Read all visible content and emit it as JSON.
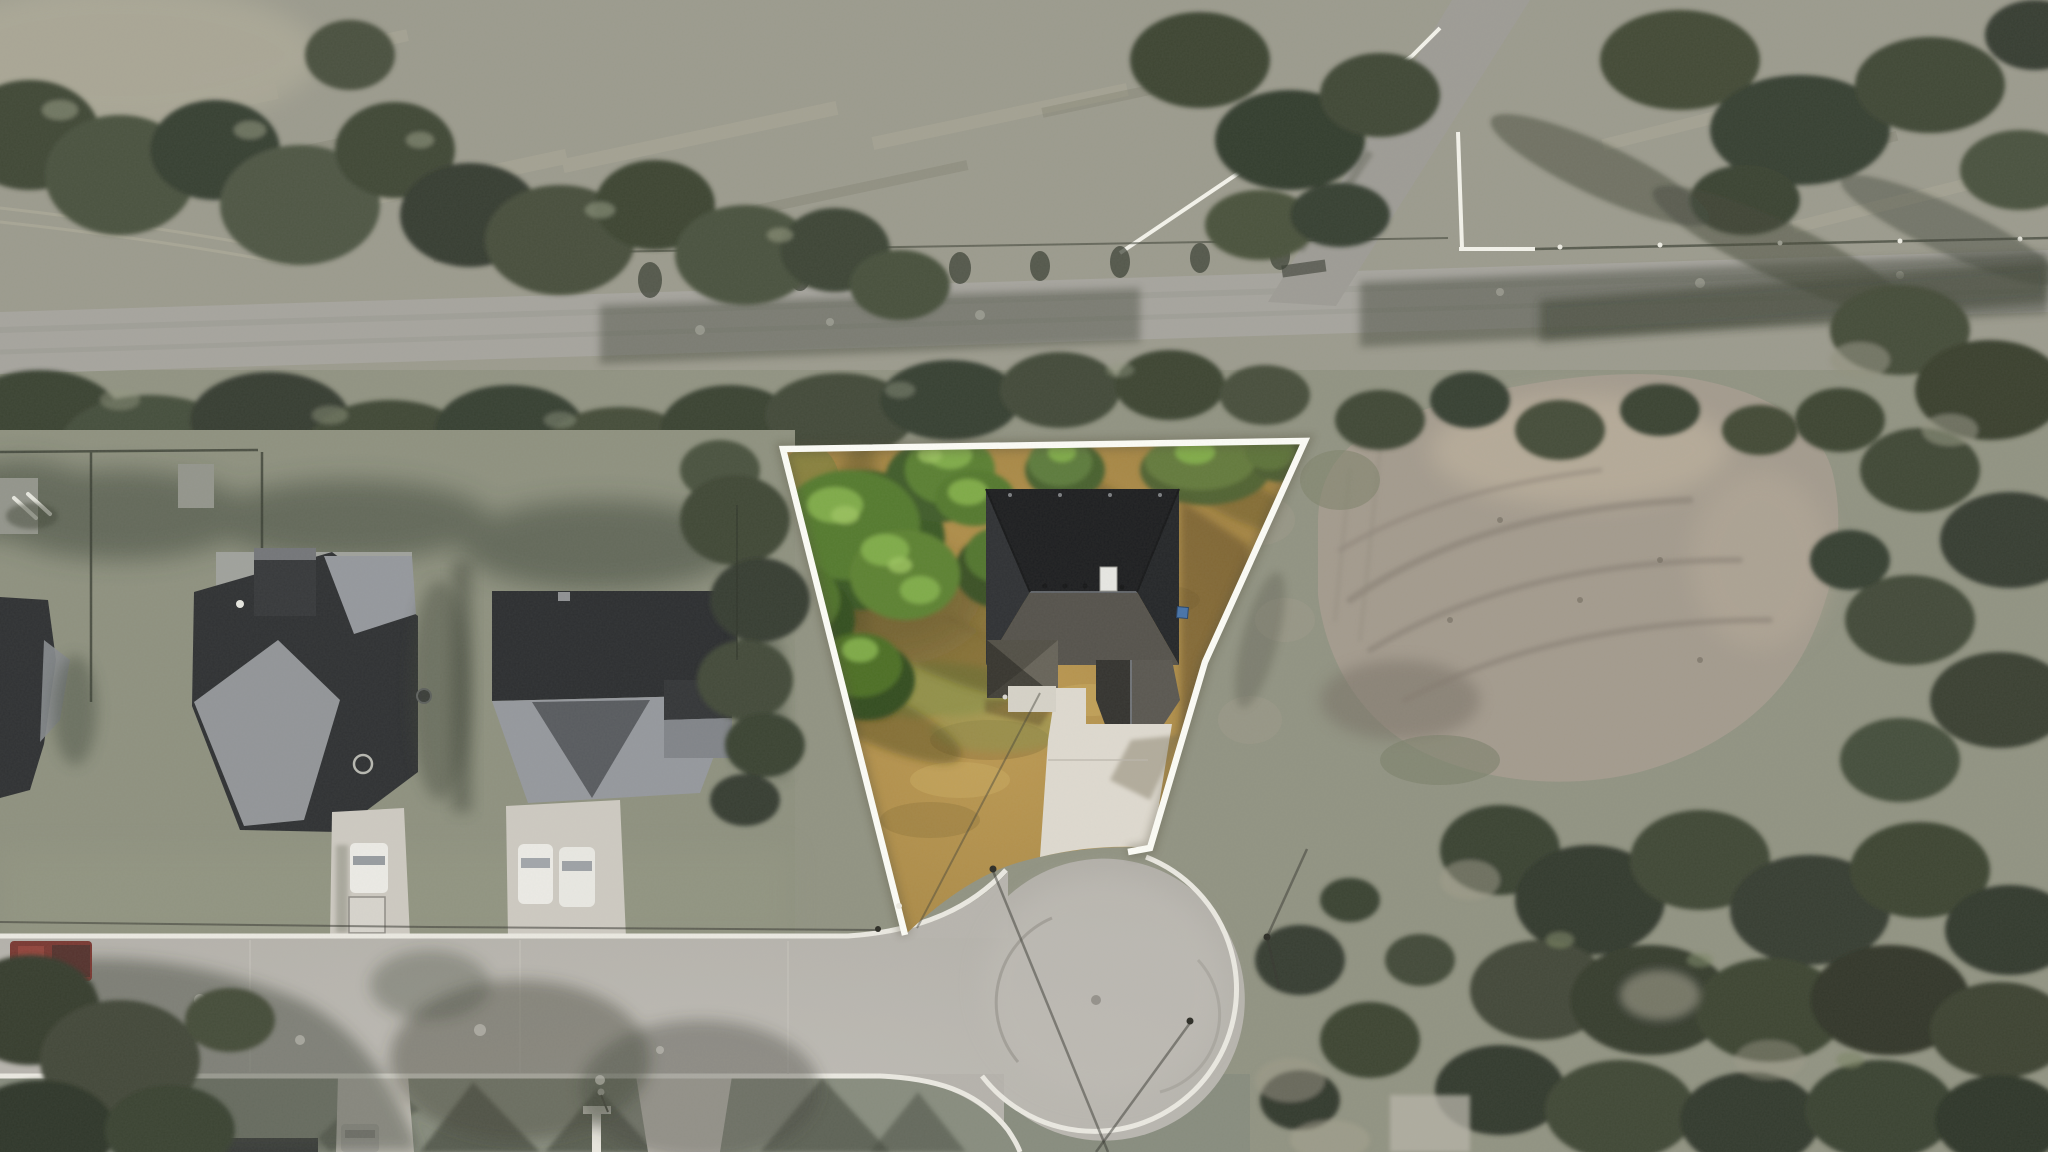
{
  "scene": {
    "type": "aerial-drone-photograph",
    "subject": "residential lot outlined in white at the head of a cul-de-sac",
    "width_px": 2048,
    "height_px": 1152
  },
  "colors": {
    "ground": "#8d8f7e",
    "field_top": "#98978a",
    "road_asphalt": "#a3a19b",
    "branch_road": "#9a9892",
    "tree_dark": "#39402f",
    "tree_mid": "#4c5442",
    "lot_grass_light": "#bb964c",
    "lot_grass_deep": "#9a7a38",
    "lot_tree_green": "#4e7427",
    "lot_tree_light": "#7fae45",
    "boundary_white": "#fdfdf8",
    "street_concrete": "#b6b3ad",
    "curb_white": "#ebe9e2",
    "driveway_concrete": "#ded9cf",
    "roof_black": "#131417",
    "roof_gray": "#4e4b45",
    "neighbor_roof_dark": "#26282b",
    "neighbor_roof_light": "#91949a",
    "dirt_ground": "#a0978a",
    "dirt_light": "#b7ab98",
    "shadow_warm": "#54411d",
    "shadow_cool": "#3a4034",
    "vehicle_white": "#ecebe6",
    "truck_red": "#74302a",
    "car_gray": "#b3b0ab",
    "chimney_white": "#e7e7e3",
    "vent_blue": "#3f6da6"
  },
  "elements": {
    "property_lot": {
      "label": "highlighted property lot with white boundary"
    },
    "subject_house": {
      "label": "house with dark shingle roof inside the lot"
    },
    "subject_driveway": {
      "label": "concrete driveway from house to cul-de-sac"
    },
    "cul_de_sac": {
      "label": "concrete cul-de-sac bulb"
    },
    "street": {
      "label": "residential street with white curbs"
    },
    "rural_road": {
      "label": "rural road crossing the top of the frame"
    },
    "branch_road": {
      "label": "branch road forking to the top-right, flanked by white fence"
    },
    "dirt_clearing": {
      "label": "graded dirt clearing east of the lot"
    },
    "neighbor_houses": {
      "label": "three neighboring houses with gray roofs to the west"
    },
    "vehicles": {
      "labels": [
        "red pickup on street",
        "white truck with trailer",
        "two white cars",
        "gray car at bottom"
      ]
    },
    "vegetation": {
      "label": "tree canopy, dry grass fields and scrub"
    }
  }
}
